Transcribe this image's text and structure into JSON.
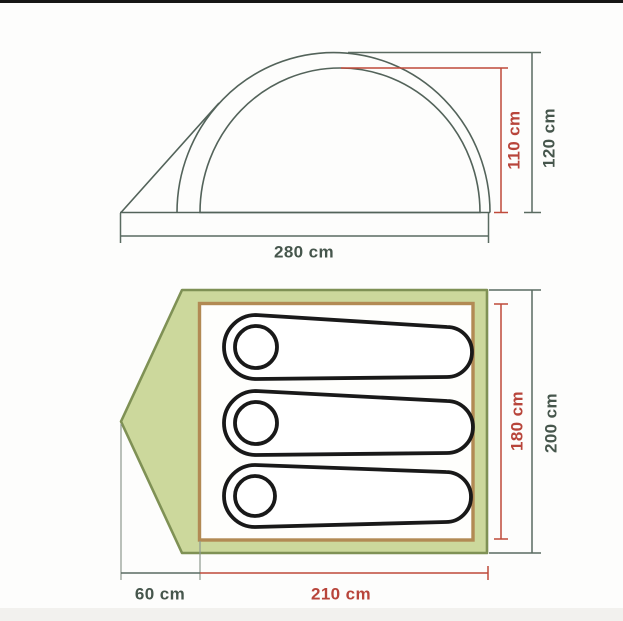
{
  "page": {
    "background": "#fdfdfc",
    "letterbox_color": "#161616"
  },
  "diagram": {
    "type": "tent-dimension-diagram",
    "views": {
      "side": {
        "name": "side-elevation",
        "labels": {
          "inner_height": "110 cm",
          "outer_height": "120 cm",
          "base_width": "280 cm"
        }
      },
      "top": {
        "name": "floor-plan",
        "sleeping_bag_count": 3,
        "labels": {
          "inner_length": "180 cm",
          "outer_length": "200 cm",
          "vestibule_depth": "60 cm",
          "floor_length": "210 cm"
        }
      }
    },
    "colors": {
      "dimension_red": "#bf4a3a",
      "dimension_dark": "#5a6b61",
      "label_red": "#b8453b",
      "label_dark": "#46564c",
      "tent_outline": "#53635a",
      "tent_fill_green": "#ccd89c",
      "tent_border_green": "#7f9155",
      "floor_border_tan": "#b28a54",
      "sleeping_bag_outline": "#191919"
    }
  }
}
